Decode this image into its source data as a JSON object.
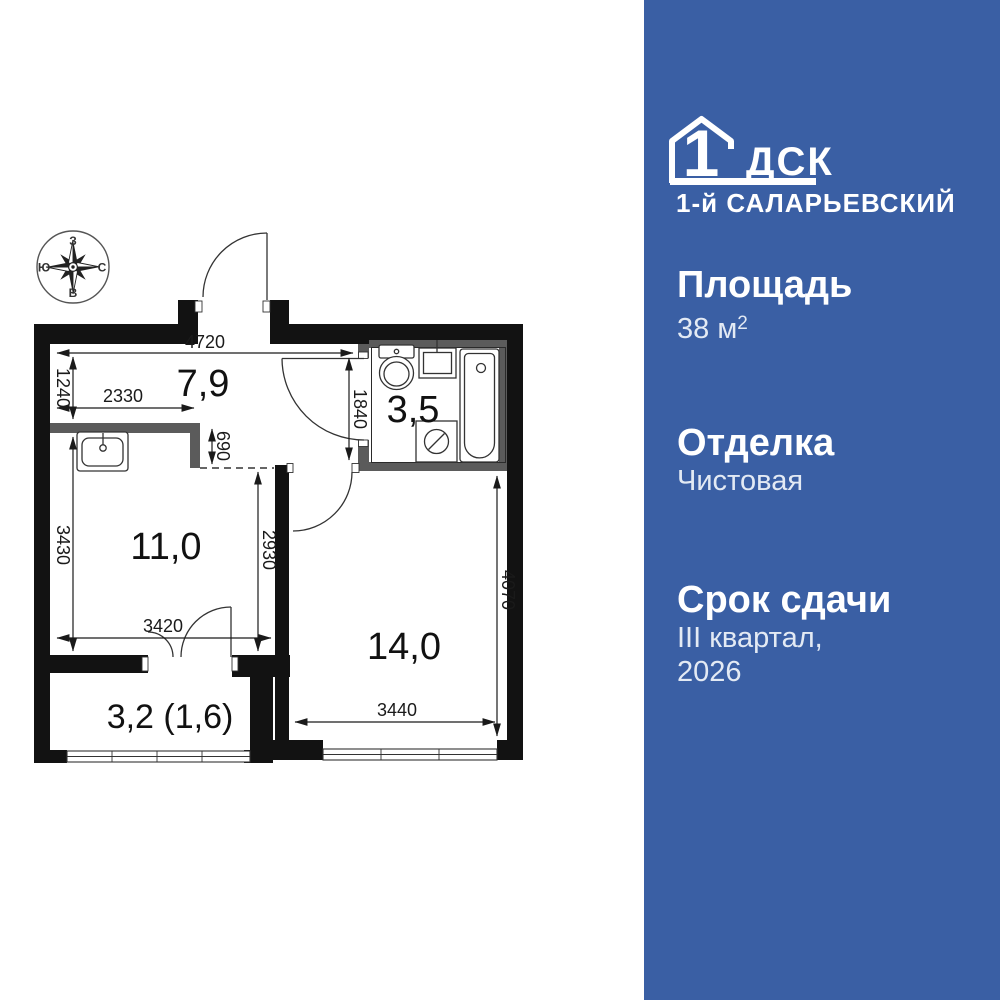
{
  "colors": {
    "sidebar_bg": "#3A5FA4",
    "wall_black": "#121212",
    "partition_gray": "#5B5B5B",
    "heading_text": "#FFFFFF",
    "value_text": "#E3EAF4"
  },
  "sidebar": {
    "logo": {
      "brand_number": "1",
      "brand_name": "ДСК",
      "project_name": "1-й САЛАРЬЕВСКИЙ"
    },
    "specs": [
      {
        "label": "Площадь",
        "value": "38 м",
        "value_sup": "2"
      },
      {
        "label": "Отделка",
        "value": "Чистовая"
      },
      {
        "label": "Срок сдачи",
        "value": "III квартал,",
        "value_line2": "2026"
      }
    ]
  },
  "plan": {
    "compass": {
      "top": "З",
      "right": "С",
      "bottom": "В",
      "left": "Ю"
    },
    "rooms": [
      {
        "name": "hallway",
        "area_label": "7,9"
      },
      {
        "name": "bathroom",
        "area_label": "3,5"
      },
      {
        "name": "kitchen-living",
        "area_label": "11,0"
      },
      {
        "name": "room",
        "area_label": "14,0"
      },
      {
        "name": "balcony",
        "area_label": "3,2 (1,6)"
      }
    ],
    "dimensions_mm": [
      "4720",
      "1240",
      "2330",
      "690",
      "1840",
      "3430",
      "2930",
      "3420",
      "3440",
      "4070"
    ]
  }
}
